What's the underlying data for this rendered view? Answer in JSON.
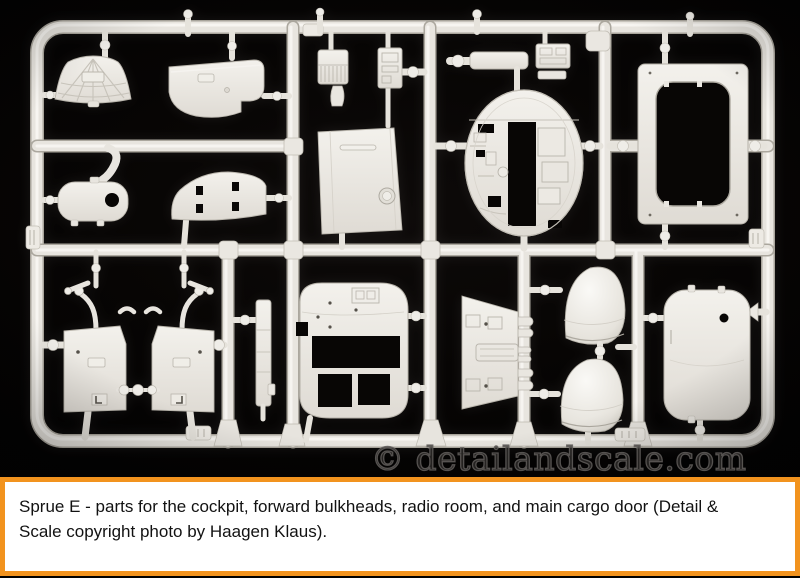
{
  "photo": {
    "watermark_text": "© detailandscale.com",
    "subject": "light-gray injection-molded plastic model sprue on black background",
    "parts": [
      "cockpit-canopy",
      "upper-bulkhead",
      "side-pod",
      "radio-floor",
      "radio-unit",
      "radio-stack",
      "bulkhead-door-panel",
      "roof-beam",
      "equipment-box",
      "fuselage-bulkhead",
      "cargo-doorframe",
      "cockpit-sidewall-left",
      "cockpit-sidewall-right",
      "control-levers",
      "side-strip",
      "rear-bulkhead",
      "radio-room-wall",
      "astrodome-upper",
      "astrodome-lower",
      "cargo-door"
    ]
  },
  "caption": {
    "lines": [
      "Sprue E - parts for the cockpit, forward bulkheads, radio room, and main cargo door (Detail &",
      "Scale copyright photo by Haagen Klaus)."
    ],
    "full_text": "Sprue E - parts for the cockpit, forward bulkheads, radio room, and main cargo door (Detail & Scale copyright photo by Haagen Klaus)."
  },
  "colors": {
    "plastic": "#E9E6E0",
    "plastic_highlight": "#F7F5F1",
    "plastic_shadow": "#B5B1A8",
    "background": "#070504",
    "caption_border": "#F2931E",
    "caption_text": "#121212"
  }
}
